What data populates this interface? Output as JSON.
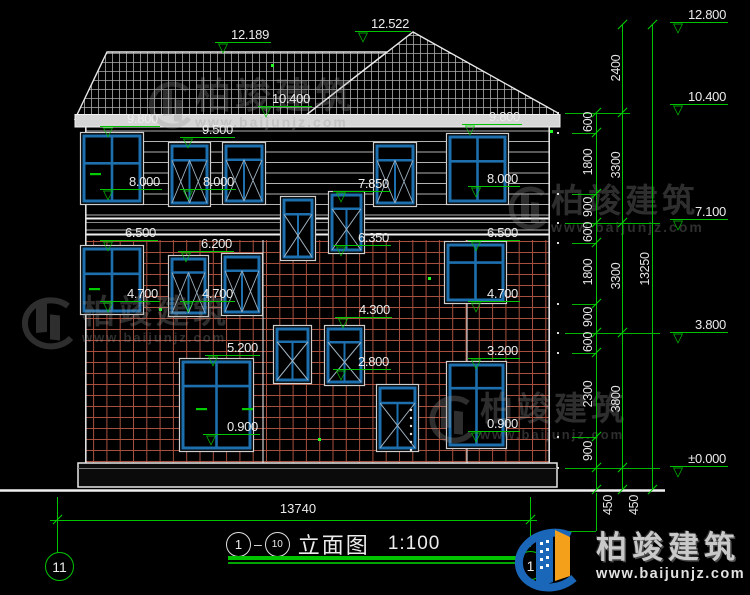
{
  "watermark": {
    "brand": "柏竣建筑",
    "url": "www.baijunjz.com"
  },
  "logo": {
    "brand": "柏竣建筑",
    "url": "www.baijunjz.com"
  },
  "roof_levels": [
    "12.189",
    "12.522",
    "10.400"
  ],
  "facade_levels": [
    "9.800",
    "9.500",
    "8.000",
    "8.000",
    "7.850",
    "9.800",
    "8.000",
    "6.500",
    "6.200",
    "6.350",
    "6.500",
    "4.700",
    "4.700",
    "4.700",
    "4.300",
    "5.200",
    "3.200",
    "2.800",
    "0.900",
    "0.900"
  ],
  "scale_levels": [
    "12.800",
    "10.400",
    "7.100",
    "3.800",
    "±0.000"
  ],
  "chains": {
    "inner": [
      "600",
      "1800",
      "900",
      "600",
      "1800",
      "900",
      "600",
      "2300",
      "900"
    ],
    "middle": [
      "2400",
      "3300",
      "3300",
      "3800"
    ],
    "total": "13250",
    "below": [
      "450",
      "450"
    ]
  },
  "footer": {
    "width": "13740",
    "axis_left": "11",
    "axis_right": "1",
    "title_from": "1",
    "title_to": "10",
    "title_name": "立面图",
    "title_scale": "1:100"
  }
}
